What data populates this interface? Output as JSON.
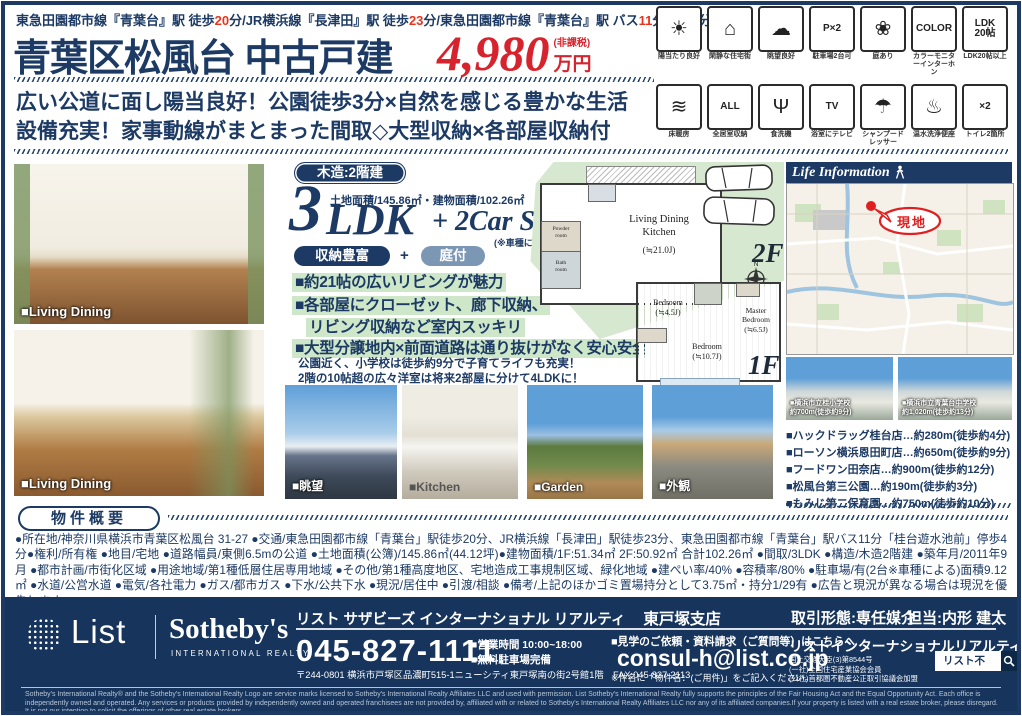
{
  "colors": {
    "navy": "#1c3a64",
    "red": "#d7232d",
    "accent_red": "#e8341c",
    "footer_navy": "#16345c",
    "highlight_green": "#cde7c8",
    "plan_green": "#d7e8d0"
  },
  "header": {
    "route": {
      "s1": "東急田園都市線『青葉台』駅 徒歩",
      "s2": "20",
      "s3": "分/JR横浜線『長津田』駅 徒歩",
      "s4": "23",
      "s5": "分/東急田園都市線『青葉台』駅 バス",
      "s6": "11",
      "s7": "分停歩",
      "s8": "4",
      "s9": "分"
    },
    "title": "青葉区松風台 中古戸建",
    "price": {
      "value": "4,980",
      "tax_note": "(非課税)",
      "unit": "万円"
    }
  },
  "feature_icons": {
    "row1": [
      {
        "label": "陽当たり良好",
        "glyph": "☀"
      },
      {
        "label": "閑静な住宅街",
        "glyph": "⌂"
      },
      {
        "label": "眺望良好",
        "glyph": "☁"
      },
      {
        "label": "駐車場2台可",
        "glyph": "P×2"
      },
      {
        "label": "庭あり",
        "glyph": "❀"
      },
      {
        "label": "カラーモニターインターホン",
        "glyph": "COLOR"
      },
      {
        "label": "LDK20帖以上",
        "glyph": "LDK\n20帖"
      }
    ],
    "row2": [
      {
        "label": "床暖房",
        "glyph": "≋"
      },
      {
        "label": "全居室収納",
        "glyph": "ALL"
      },
      {
        "label": "食洗機",
        "glyph": "Ψ"
      },
      {
        "label": "浴室にテレビ",
        "glyph": "TV"
      },
      {
        "label": "シャンプードレッサー",
        "glyph": "☂"
      },
      {
        "label": "温水洗浄便座",
        "glyph": "♨"
      },
      {
        "label": "トイレ2箇所",
        "glyph": "×2"
      }
    ]
  },
  "catch_copy": {
    "line1": "広い公道に面し陽当良好！公園徒歩3分×自然を感じる豊かな生活",
    "line2": "設備充実！家事動線がまとまった間取◇大型収納×各部屋収納付"
  },
  "spec": {
    "structure_badge": "木造:2階建",
    "area_line": "土地面積/145.86㎡・建物面積/102.26㎡",
    "layout_num": "3",
    "layout_ldk": "LDK",
    "layout_plus": "+ 2Car Space",
    "car_note": "(※車種による)",
    "badge_storage": "収納豊富",
    "badge_join": "+",
    "badge_garden": "庭付"
  },
  "highlights": {
    "bullets": [
      "■約21帖の広いリビングが魅力",
      "■各部屋にクローゼット、廊下収納、",
      "リビング収納など室内スッキリ",
      "■大型分譲地内×前面道路は通り抜けがなく安心安全"
    ],
    "notes": [
      "公園近く、小学校は徒歩約9分で子育てライフも充実！",
      "2階の10帖超の広々洋室は将来2部屋に分けて4LDKに！"
    ]
  },
  "floorplan": {
    "f2_label": "2F",
    "f1_label": "1F",
    "compass_n": "N",
    "ldk_room": "Living Dining\nKitchen",
    "ldk_size": "(≒21.0J)",
    "powder": "Powder\nroom",
    "bath": "Bath\nroom",
    "bed1": "Bedroom\n(≒4.5J)",
    "master": "Master\nBedroom\n(≒6.5J)",
    "bed2": "Bedroom\n(≒10.7J)"
  },
  "photos": {
    "living1": "■Living Dining",
    "living2": "■Living Dining",
    "view": "■眺望",
    "kitchen": "■Kitchen",
    "garden": "■Garden",
    "exterior": "■外観"
  },
  "map": {
    "title": "Life Information",
    "marker": "現地",
    "school1_line1": "■横浜市立桂小学校",
    "school1_line2": "約700m(徒歩約9分)",
    "school2_line1": "■横浜市立青葉台中学校",
    "school2_line2": "約1,020m(徒歩約13分)"
  },
  "facilities": [
    "■ハックドラッグ桂台店…約280m(徒歩約4分)",
    "■ローソン横浜恩田町店…約650m(徒歩約9分)",
    "■フードワン田奈店…約900m(徒歩約12分)",
    "■松風台第三公園…約190m(徒歩約3分)",
    "■もみじ第二保育園…約750m(徒歩約10分)"
  ],
  "overview": {
    "badge": "物件概要",
    "text": "●所在地/神奈川県横浜市青葉区松風台 31-27 ●交通/東急田園都市線「青葉台」駅徒歩20分、JR横浜線「長津田」駅徒歩23分、東急田園都市線「青葉台」駅バス11分「桂台遊水池前」停歩4分●権利/所有権 ●地目/宅地 ●道路幅員/東側6.5mの公道 ●土地面積(公簿)/145.86㎡(44.12坪)●建物面積/1F:51.34㎡ 2F:50.92㎡ 合計102.26㎡ ●間取/3LDK ●構造/木造2階建 ●築年月/2011年9月 ●都市計画/市街化区域 ●用途地域/第1種低層住居専用地域 ●その他/第1種高度地区、宅地造成工事規制区域、緑化地域 ●建ぺい率/40% ●容積率/80% ●駐車場/有(2台※車種による)面積9.12㎡ ●水道/公営水道 ●電気/各社電力 ●ガス/都市ガス ●下水/公共下水 ●現況/居住中 ●引渡/相談 ●備考/上記のほかゴミ置場持分として3.75㎡・持分1/29有 ●広告と現況が異なる場合は現況を優先します。"
  },
  "footer": {
    "logo_list": "List",
    "logo_sothebys": "Sotheby's",
    "logo_sub": "INTERNATIONAL REALTY",
    "company_line": "リスト サザビーズ インターナショナル リアルティ",
    "branch": "東戸塚支店",
    "phone": "045-827-1111",
    "address": "〒244-0801 横浜市戸塚区品濃町515-1ニューシティ東戸塚南の街2号館1階　FAX:045-827-2113",
    "hours": "■営業時間 10:00~18:00",
    "parking": "■無料駐車場完備",
    "contact_label": "■見学のご依頼・資料請求（ご質問等）はこちらへ",
    "email": "consul-h@list.co.jp",
    "email_note": "※件名に「物件名：(ご用件)」をご記入ください。",
    "deal_type": "取引形態:専任媒介",
    "agent": "担当:内形 建太",
    "company_full": "リストインターナショナルリアルティ株式会社",
    "license1": "国土交通大臣(3)第8544号",
    "license2": "(一社)全国住宅産業協会会員",
    "license3": "(公社)首都圏不動産公正取引協議会加盟",
    "search_label": "リスト不動産",
    "disclaimer": "Sotheby's International Realty® and the Sotheby's International Realty Logo are service marks licensed to Sotheby's International Realty Affiliates LLC and used with permission. List Sotheby's International Realty fully supports the principles of the Fair Housing Act and the Equal Opportunity Act. Each office is independently owned and operated. Any services or products provided by independently owned and operated franchisees are not provided by, affiliated with or related to Sotheby's International Realty Affiliates LLC nor any of its affiliated companies.If your property is listed with a real estate broker, please disregard. It is not our intention to solicit the offerings of other real estate brokers."
  }
}
